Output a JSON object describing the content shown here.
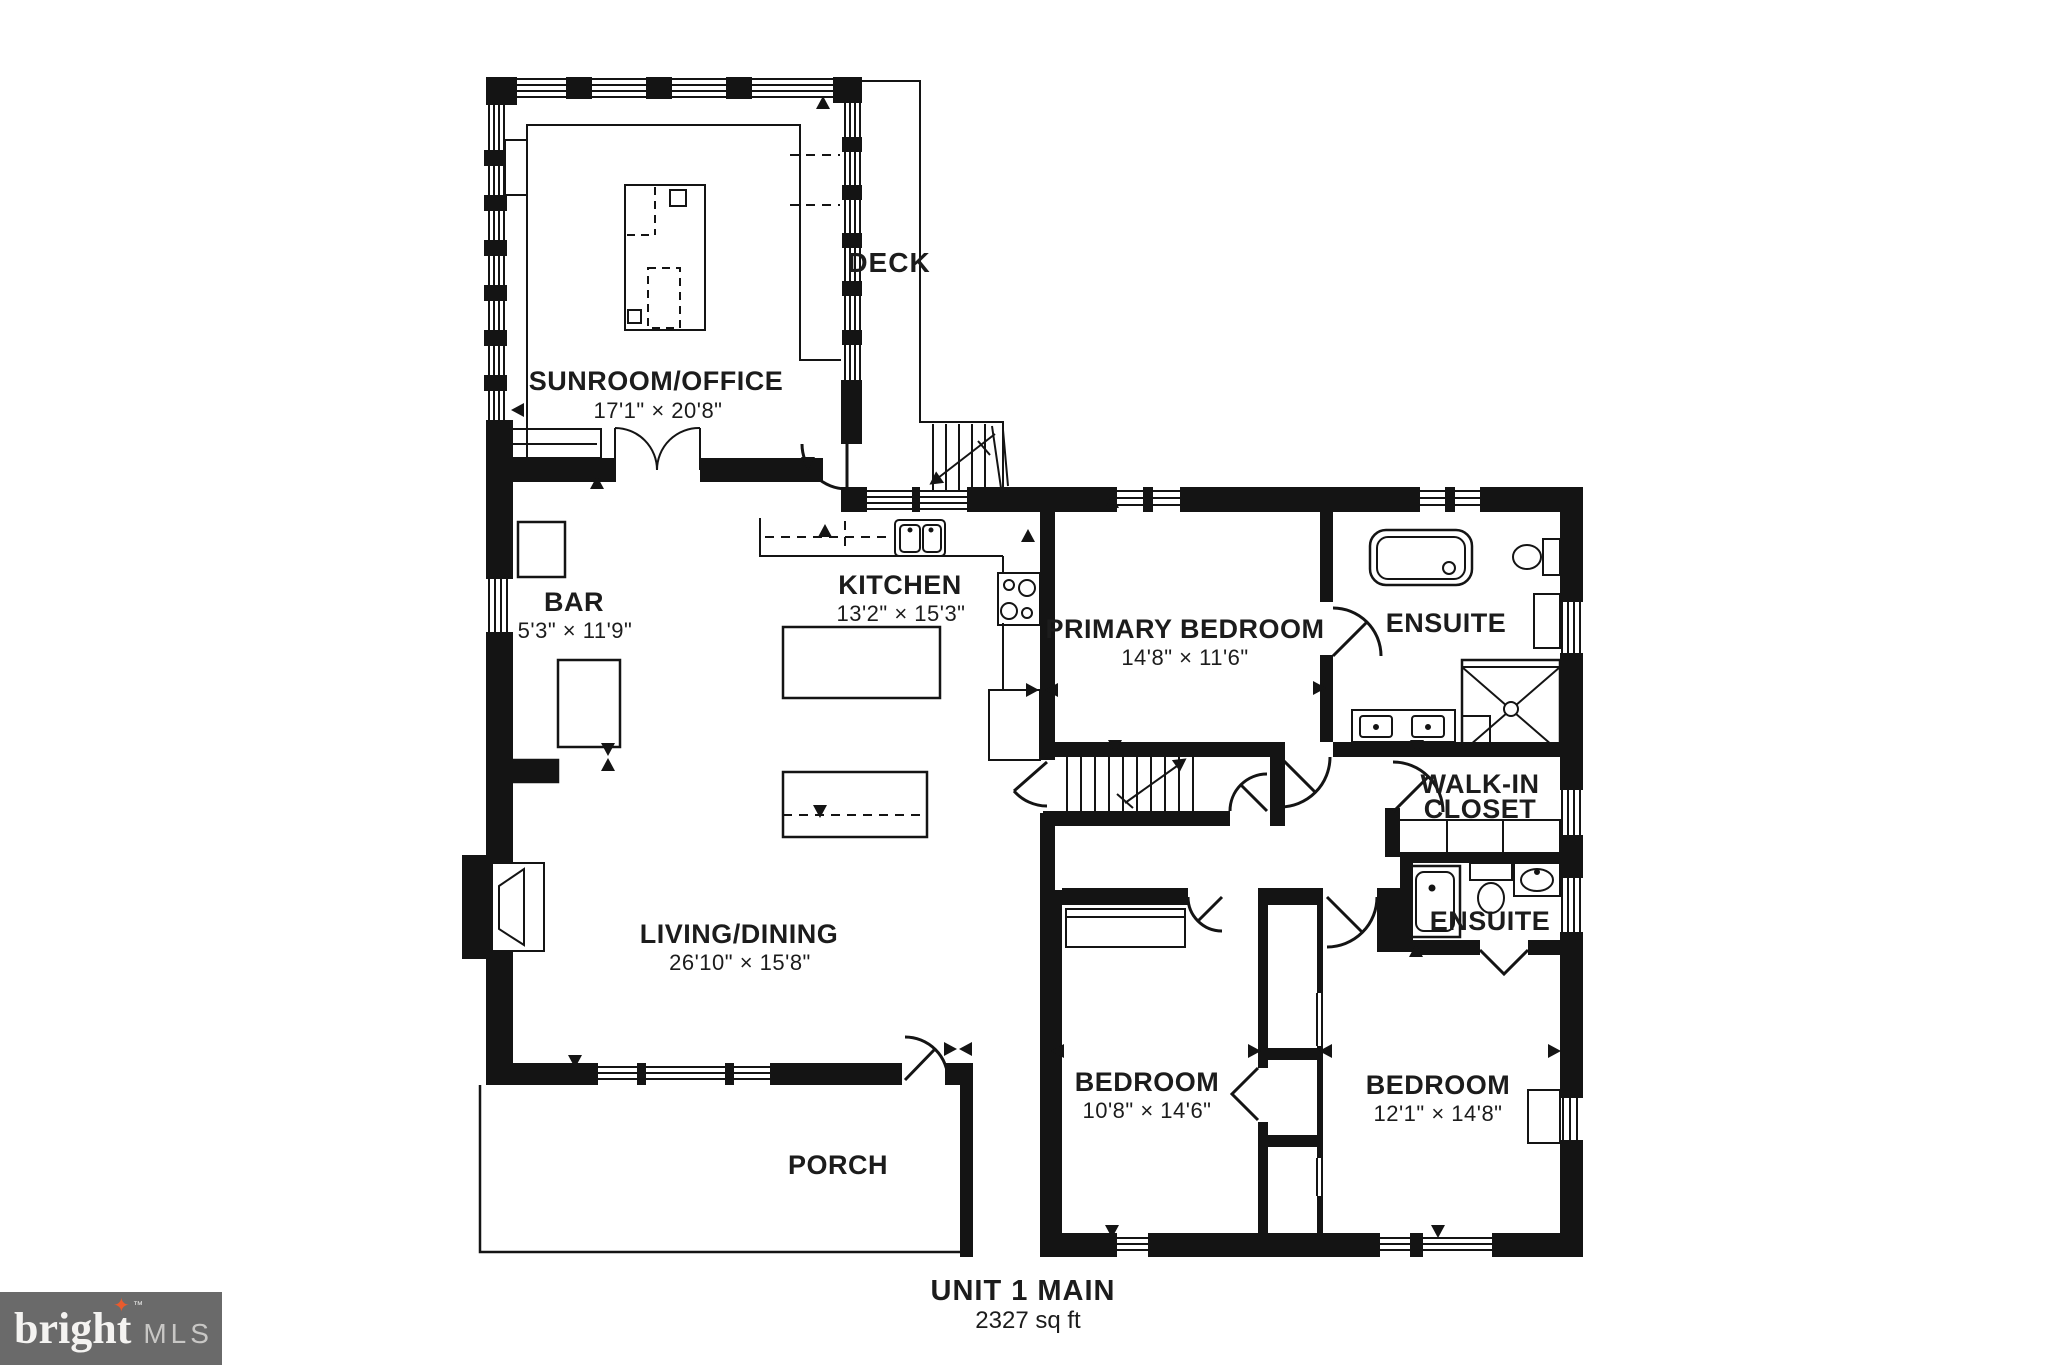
{
  "plan": {
    "unit_title": "UNIT 1 MAIN",
    "unit_area": "2327 sq ft"
  },
  "rooms": {
    "sunroom": {
      "name": "SUNROOM/OFFICE",
      "dims": "17'1\" × 20'8\""
    },
    "deck": {
      "name": "DECK"
    },
    "bar": {
      "name": "BAR",
      "dims": "5'3\" × 11'9\""
    },
    "kitchen": {
      "name": "KITCHEN",
      "dims": "13'2\" × 15'3\""
    },
    "primary_bedroom": {
      "name": "PRIMARY BEDROOM",
      "dims": "14'8\" × 11'6\""
    },
    "ensuite_primary": {
      "name": "ENSUITE"
    },
    "walk_in_closet": {
      "line1": "WALK-IN",
      "line2": "CLOSET"
    },
    "ensuite_second": {
      "name": "ENSUITE"
    },
    "living_dining": {
      "name": "LIVING/DINING",
      "dims": "26'10\" × 15'8\""
    },
    "bedroom_left": {
      "name": "BEDROOM",
      "dims": "10'8\" × 14'6\""
    },
    "bedroom_right": {
      "name": "BEDROOM",
      "dims": "12'1\" × 14'8\""
    },
    "porch": {
      "name": "PORCH"
    }
  },
  "logo": {
    "brand": "bright",
    "tm": "™",
    "mls": "MLS",
    "star": "✦"
  },
  "colors": {
    "walls": "#141414",
    "background": "#ffffff",
    "logo_bg": "#6a6a6a",
    "logo_star": "#e95b2d",
    "logo_text": "#f4f3f1",
    "logo_mls": "#c8c7c5"
  }
}
